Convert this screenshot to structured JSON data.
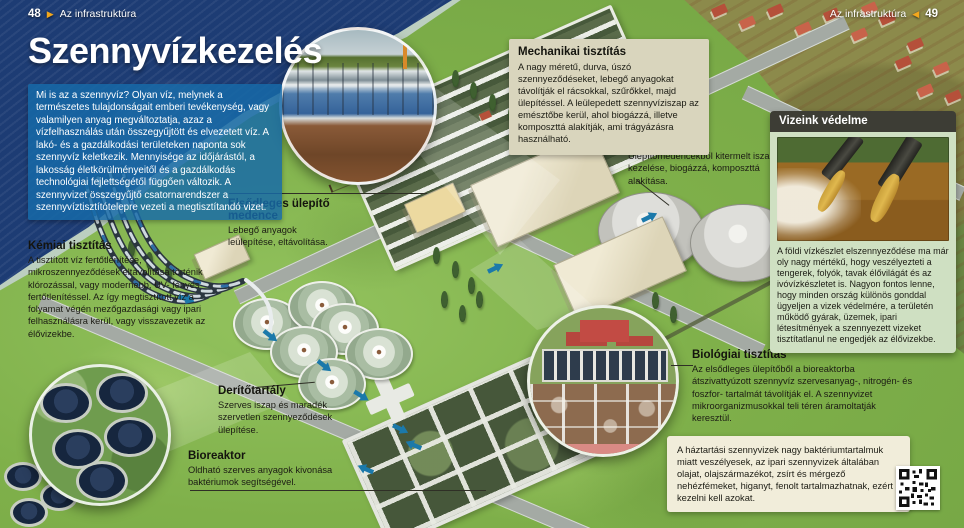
{
  "page": {
    "header_left": {
      "page_num": "48",
      "section": "Az infrastruktúra"
    },
    "header_right": {
      "page_num": "49",
      "section": "Az infrastruktúra"
    },
    "title": "Szennyvízkezelés",
    "intro": "Mi is az a szennyvíz? Olyan víz, melynek a természetes tulajdonságait emberi tevékenység, vagy valamilyen anyag megváltoztatja, azaz a vízfelhasználás után összegyűjtött és elvezetett víz. A lakó- és a gazdálkodási területeken naponta sok szennyvíz keletkezik. Mennyisége az időjárástól, a lakosság életkörülményeitől és a gazdálkodás technológiai fejlettségétől függően változik. A szennyvizet összegyűjtő csatornarendszer a szennyvíztisztítótelepre vezeti a megtisztítandó vizet."
  },
  "callouts": {
    "mechanikai": {
      "title": "Mechanikai tisztítás",
      "body": "A nagy méretű, durva, úszó szennyeződéseket, lebegő anyagokat távolítják el rácsokkal, szűrőkkel, majd ülepítéssel. A leülepedett szennyvíziszap az emésztőbe kerül, ahol biogázzá, illetve komposzttá alakítják, ami trágyázásra használható."
    },
    "emeszto": {
      "title": "Emésztő",
      "body": "Ülepítőmedencékből kitermelt iszap kezelése, biogázzá, komposzttá alakítása."
    },
    "elsodleges": {
      "title": "Elsődleges ülepítő medence",
      "body": "Lebegő anyagok leülepítése, eltávolítása."
    },
    "kemiai": {
      "title": "Kémiai tisztítás",
      "body": "A tisztított víz fertőtlenítése, mikroszennyeződések eltávolítása történik klórozással, vagy modernebb, UV- fényes fertőtlenítéssel. Az így megtisztított víz a folyamat végén mezőgazdasági vagy ipari felhasználásra kerül, vagy visszavezetik az élővizekbe."
    },
    "deritotartaly": {
      "title": "Derítőtartály",
      "body": "Szerves iszap és maradék szervetlen szennyeződések ülepítése."
    },
    "bioreaktor": {
      "title": "Bioreaktor",
      "body": "Oldható szerves anyagok kivonása baktériumok segítségével."
    },
    "biologiai": {
      "title": "Biológiai tisztítás",
      "body": "Az elsődleges ülepítőből a bioreaktorba átszivattyúzott szennyvíz szervesanyag-, nitrogén- és foszfor- tartalmát távolítják el. A szennyvizet mikroorganizmusokkal teli téren áramoltatják keresztül."
    }
  },
  "sidebar_box": {
    "title": "Vizeink védelme",
    "body": "A földi vízkészlet elszennyeződése ma már oly nagy mértékű, hogy veszélyezteti a tengerek, folyók, tavak élővilágát és az ivóvízkészletet is. Nagyon fontos lenne, hogy minden ország különös gonddal ügyeljen a vizek védelmére, a területén működő gyárak, üzemek, ipari létesítmények a szennyezett vizeket tisztítatlanul ne engedjék az élővizekbe."
  },
  "warning_box": {
    "body": "A háztartási szennyvizek nagy baktériumtartalmuk miatt veszélyesek, az ipari szennyvizek általában olajat, olajszármazékot, zsírt és mérgező nehézfémeket, higanyt, fenolt tartalmazhatnak, ezért kezelni kell azokat."
  },
  "icons": {
    "header_arrow_right": "▶",
    "header_arrow_left": "◀"
  },
  "colors": {
    "accent_orange": "#f2a71d",
    "intro_panel_blue": "#176aa8",
    "beige_box": "#d9d5bd",
    "green_box_body": "#cfe0c2",
    "green_box_header": "#3d3d35",
    "cream_box": "#f1edda",
    "sea_navy": "#1d3c74",
    "grass_green": "#7fb04a",
    "flow_arrow_teal": "#1b79aa"
  }
}
